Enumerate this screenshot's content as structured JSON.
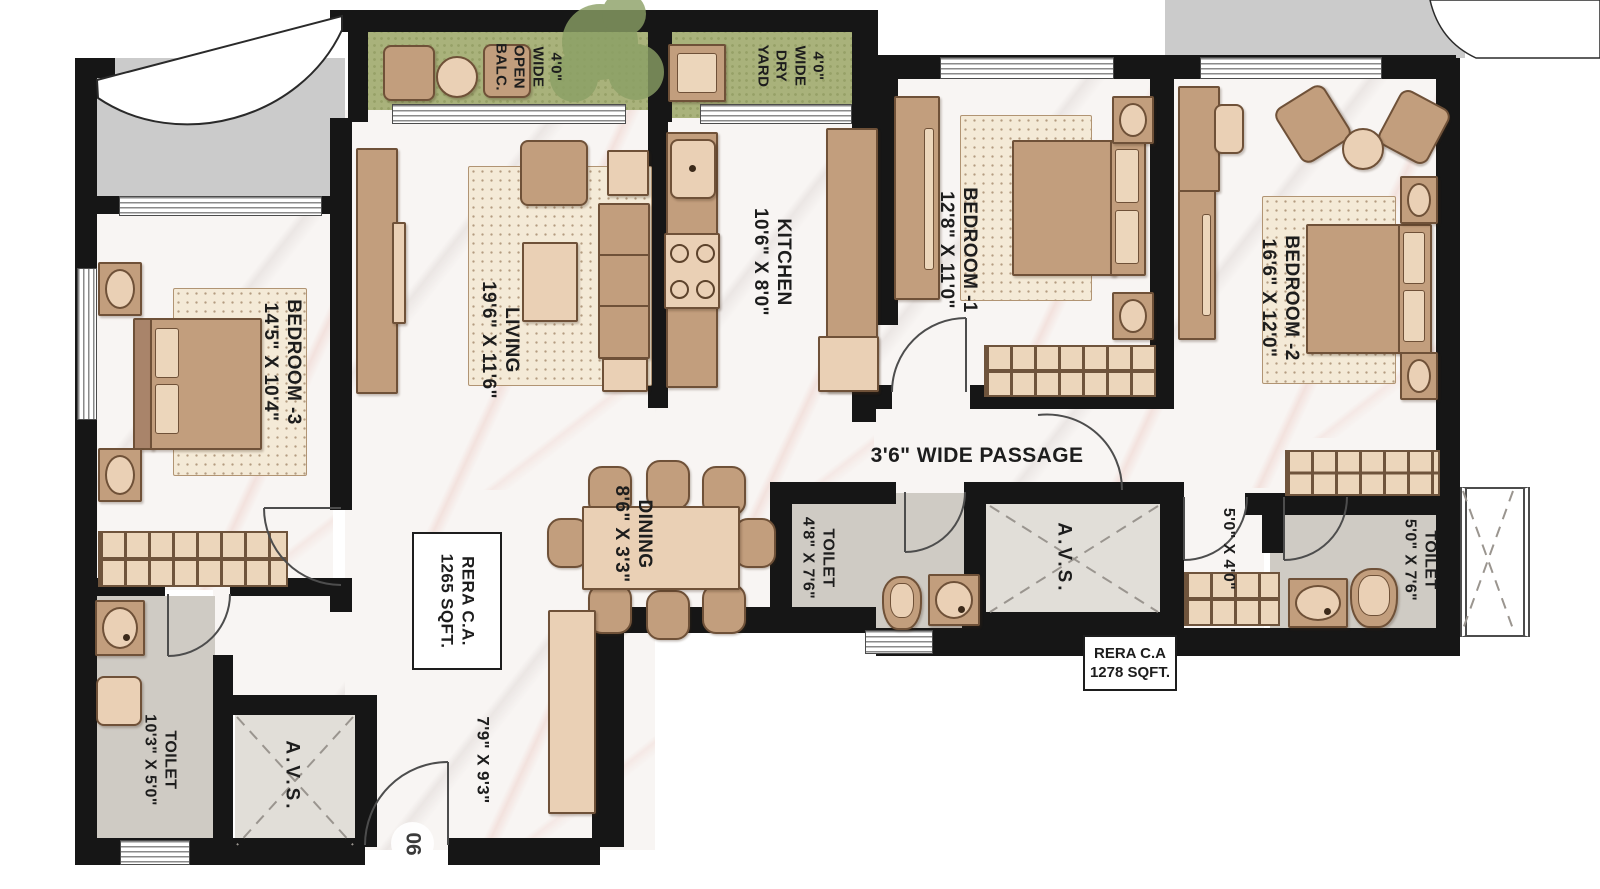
{
  "plan": {
    "unit_number": "06",
    "passage_label": "3'6\" WIDE PASSAGE",
    "avs_label": "A.V.S.",
    "rera_inner": {
      "line1": "RERA C.A.",
      "line2": "1265 SQFT."
    },
    "rera_outer": {
      "line1": "RERA C.A",
      "line2": "1278 SQFT."
    },
    "balcony": {
      "lines": [
        "4'0\"",
        "WIDE",
        "OPEN",
        "BALC."
      ]
    },
    "dry_yard": {
      "lines": [
        "4'0\"",
        "WIDE",
        "DRY",
        "YARD"
      ]
    },
    "rooms": {
      "living": {
        "name": "LIVING",
        "dims": "19'6\" X 11'6\""
      },
      "kitchen": {
        "name": "KITCHEN",
        "dims": "10'6\" X 8'0\""
      },
      "dining": {
        "name": "DINING",
        "dims": "8'6\" X 3'3\""
      },
      "bedroom1": {
        "name": "BEDROOM -1",
        "dims": "12'8\" X 11'0\""
      },
      "bedroom2": {
        "name": "BEDROOM -2",
        "dims": "16'6\" X 12'0\""
      },
      "bedroom3": {
        "name": "BEDROOM -3",
        "dims": "14'5\" X 10'4\""
      },
      "toilet_center": {
        "name": "TOILET",
        "dims": "4'8\" X 7'6\""
      },
      "toilet_right": {
        "name": "TOILET",
        "dims": "5'0\" X 7'6\""
      },
      "toilet_left": {
        "name": "TOILET",
        "dims": "10'3\" X 5'0\""
      },
      "lobby": {
        "dims": "5'0\" X 4'0\""
      },
      "foyer": {
        "dims": "7'9\" X 9'3\""
      }
    },
    "colors": {
      "wall": "#161616",
      "floor": "#f8f5f3",
      "balcony_green": "#a9b27b",
      "furniture": "#c29e7d",
      "wet_floor": "#cfcbc4"
    }
  }
}
